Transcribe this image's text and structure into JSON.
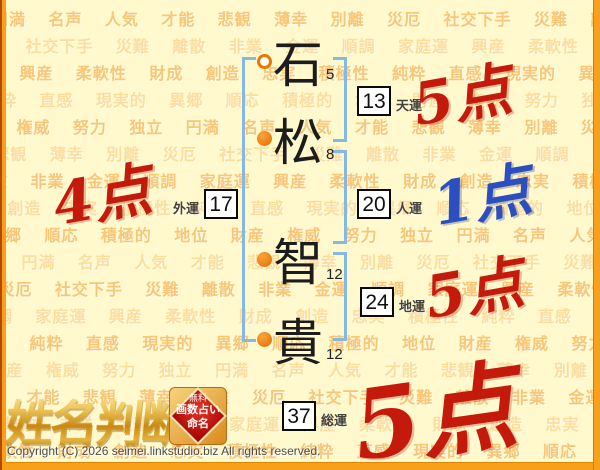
{
  "page": {
    "copyright": "Copyright (C) 2026 seimei.linkstudio.biz All rights reserved.",
    "colors": {
      "background": "#FFF9CD",
      "frame_orange": "#F9A01B",
      "frame_dark": "#B34A00",
      "bracket_blue": "#85B9E4",
      "marker_orange": "#E87800",
      "score_red": "#C41A0C",
      "score_blue": "#2B4FC0",
      "logo_gold": "#D79A1E"
    },
    "background_words": [
      "円満",
      "名声",
      "人気",
      "才能",
      "悲観",
      "薄幸",
      "別離",
      "災厄",
      "社交下手",
      "災難",
      "離散",
      "非業",
      "金運",
      "順調",
      "家庭運",
      "興産",
      "柔軟性",
      "財成",
      "創造",
      "忠実",
      "積極性",
      "純粋",
      "直感",
      "現実的",
      "異郷",
      "順応",
      "積極的",
      "地位",
      "財産",
      "権威",
      "努力",
      "独立"
    ]
  },
  "name_chart": {
    "characters": [
      {
        "char": "石",
        "strokes": "5",
        "marker": "open-circle"
      },
      {
        "char": "松",
        "strokes": "8",
        "marker": "filled-circle"
      },
      {
        "char": "智",
        "strokes": "12",
        "marker": "filled-circle"
      },
      {
        "char": "貴",
        "strokes": "12",
        "marker": "filled-circle"
      }
    ],
    "fortunes": [
      {
        "id": "tenun",
        "value": "13",
        "label": "天運",
        "score": "5点",
        "score_color": "#C41A0C"
      },
      {
        "id": "gaiun",
        "value": "17",
        "label": "外運",
        "score": "4点",
        "score_color": "#C41A0C"
      },
      {
        "id": "jinun",
        "value": "20",
        "label": "人運",
        "score": "1点",
        "score_color": "#2B4FC0"
      },
      {
        "id": "chiun",
        "value": "24",
        "label": "地運",
        "score": "5点",
        "score_color": "#C41A0C"
      },
      {
        "id": "souun",
        "value": "37",
        "label": "総運",
        "score": "5点",
        "score_color": "#C41A0C"
      }
    ]
  },
  "logo": {
    "title": "姓名判断",
    "badge_lines": [
      "無料",
      "画数占い",
      "命名"
    ]
  }
}
